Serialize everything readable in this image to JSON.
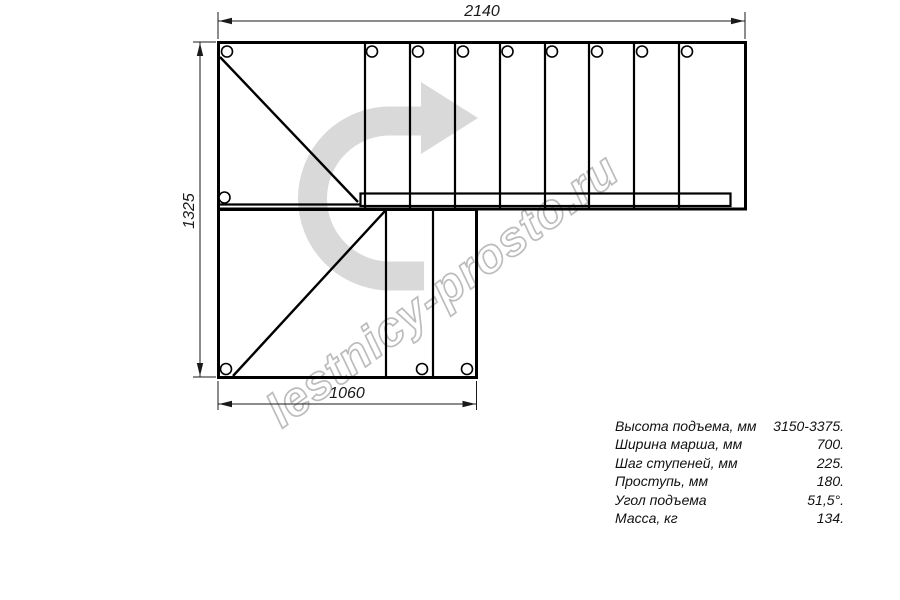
{
  "watermark": {
    "text": "lestnicy-prosto.ru"
  },
  "dimensions": {
    "top_width": "2140",
    "left_height": "1325",
    "bottom_width": "1060"
  },
  "specs": {
    "rows": [
      {
        "label": "Высота подъема, мм",
        "value": "3150-3375."
      },
      {
        "label": "Ширина марша, мм",
        "value": "700."
      },
      {
        "label": "Шаг ступеней, мм",
        "value": "225."
      },
      {
        "label": "Проступь, мм",
        "value": "180."
      },
      {
        "label": "Угол подъема",
        "value": "51,5°."
      },
      {
        "label": "Масса, кг",
        "value": "134."
      }
    ]
  },
  "colors": {
    "background": "#ffffff",
    "drawing_line": "#000000",
    "direction_arrow": "#d9d9d9",
    "watermark_outline": "#bcbcbc"
  }
}
